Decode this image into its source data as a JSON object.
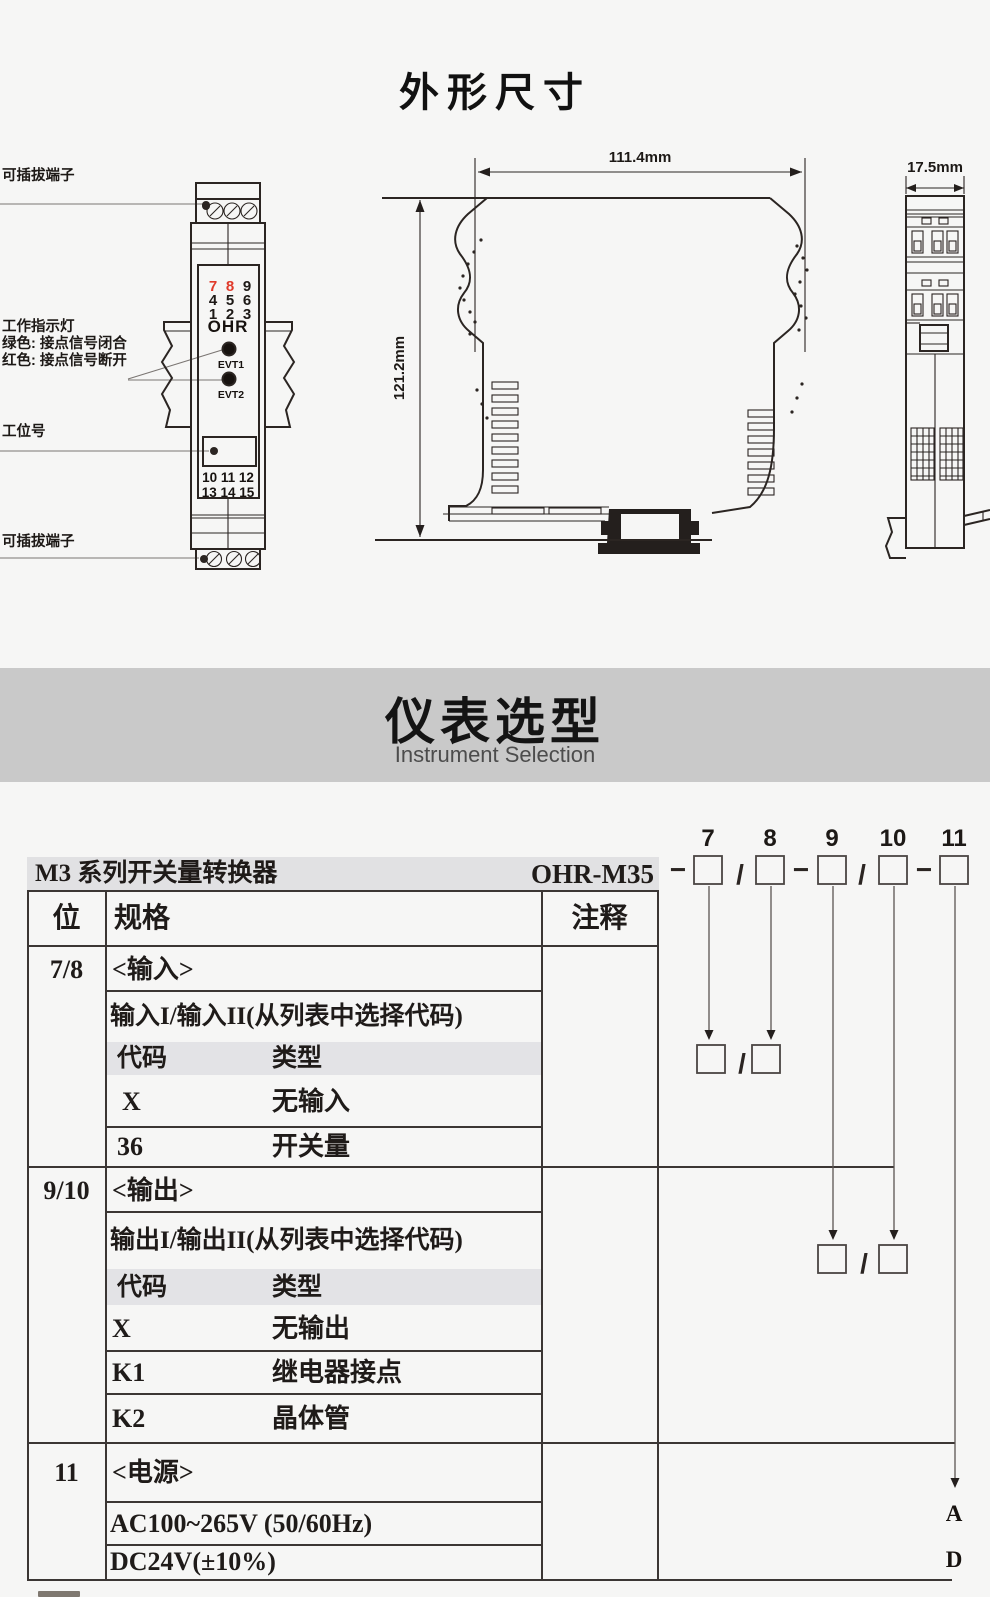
{
  "page": {
    "title": "外形尺寸"
  },
  "outline": {
    "labels": {
      "terminal_top": "可插拔端子",
      "indicator_title": "工作指示灯",
      "indicator_green": "绿色: 接点信号闭合",
      "indicator_red": "红色: 接点信号断开",
      "station": "工位号",
      "terminal_bottom": "可插拔端子"
    },
    "module": {
      "brand": "OHR",
      "led1": "EVT1",
      "led2": "EVT2",
      "digits": [
        "7",
        "8",
        "9",
        "4",
        "5",
        "6",
        "1",
        "2",
        "3"
      ],
      "terminal_row1": "10 11 12",
      "terminal_row2": "13 14 15"
    },
    "dims": {
      "width": "111.4mm",
      "height": "121.2mm",
      "depth": "17.5mm"
    }
  },
  "selection": {
    "heading": "仪表选型",
    "subheading": "Instrument Selection",
    "order": {
      "digits": [
        "7",
        "8",
        "9",
        "10",
        "11"
      ],
      "dash": "−",
      "slash": "/"
    },
    "table": {
      "product": "M3 系列开关量转换器",
      "model": "OHR-M35",
      "col_pos": "位",
      "col_spec": "规格",
      "col_note": "注释",
      "sections": [
        {
          "pos": "7/8",
          "name": "<输入>",
          "desc": "输入I/输入II(从列表中选择代码)",
          "code_header": "代码",
          "type_header": "类型",
          "rows": [
            {
              "code": "X",
              "type": "无输入"
            },
            {
              "code": "36",
              "type": "开关量"
            }
          ]
        },
        {
          "pos": "9/10",
          "name": "<输出>",
          "desc": "输出I/输出II(从列表中选择代码)",
          "code_header": "代码",
          "type_header": "类型",
          "rows": [
            {
              "code": "X",
              "type": "无输出"
            },
            {
              "code": "K1",
              "type": "继电器接点"
            },
            {
              "code": "K2",
              "type": "晶体管"
            }
          ]
        },
        {
          "pos": "11",
          "name": "<电源>",
          "rows": [
            {
              "code": "AC100~265V (50/60Hz)",
              "note": "A"
            },
            {
              "code": "DC24V(±10%)",
              "note": "D"
            }
          ]
        }
      ]
    }
  }
}
